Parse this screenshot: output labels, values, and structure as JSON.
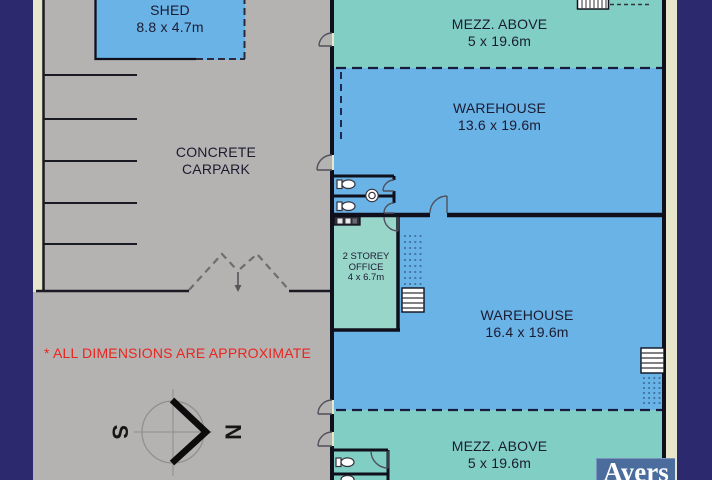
{
  "rooms": {
    "shed": {
      "name": "SHED",
      "dims": "8.8 x 4.7m"
    },
    "carpark": {
      "line1": "CONCRETE",
      "line2": "CARPARK"
    },
    "mezz_top": {
      "name": "MEZZ. ABOVE",
      "dims": "5 x 19.6m"
    },
    "warehouse_top": {
      "name": "WAREHOUSE",
      "dims": "13.6 x 19.6m"
    },
    "office": {
      "line1": "2 STOREY",
      "line2": "OFFICE",
      "dims": "4 x 6.7m"
    },
    "warehouse_bottom": {
      "name": "WAREHOUSE",
      "dims": "16.4 x 19.6m"
    },
    "mezz_bottom": {
      "name": "MEZZ. ABOVE",
      "dims": "5 x 19.6m"
    }
  },
  "notes": {
    "disclaimer": "* ALL DIMENSIONS ARE APPROXIMATE"
  },
  "compass": {
    "north": "N",
    "south": "S"
  },
  "branding": {
    "agency": "Ayers"
  },
  "colors": {
    "border_navy": "#2c296e",
    "page_cream": "#e8e6ca",
    "carpark_gray": "#b5b3b1",
    "warehouse_blue": "#6ab3e7",
    "mezzanine_teal": "#80cec4",
    "office_teal": "#98d6ca",
    "wall_black": "#10101c",
    "disclaimer_red": "#e92520",
    "logo_blue": "#4a6d9e"
  }
}
